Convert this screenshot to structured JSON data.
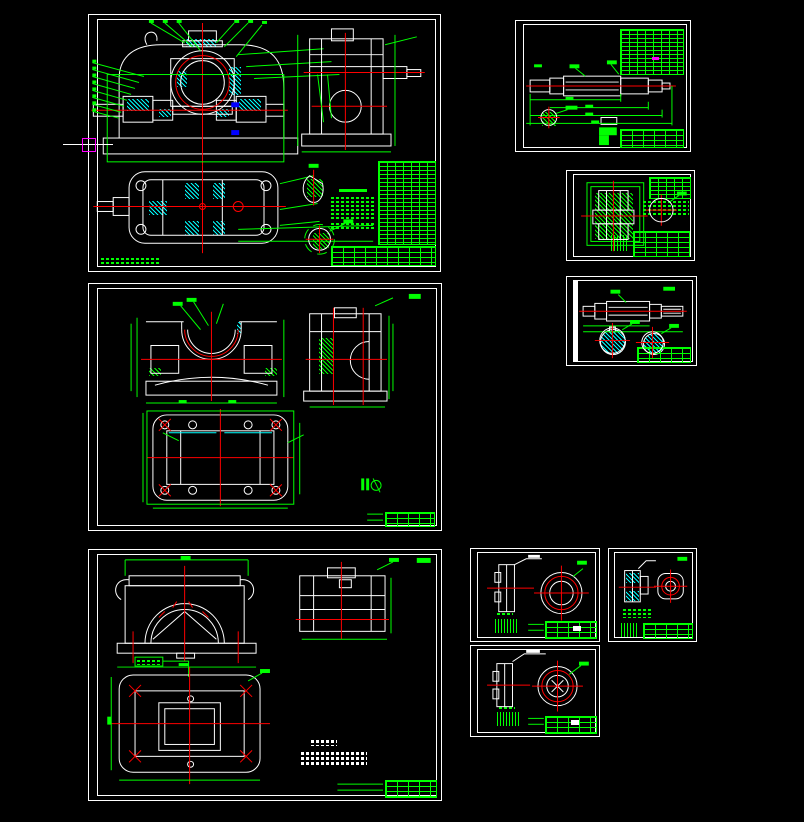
{
  "window": {
    "type": "cad-drawing-workspace",
    "background": "#000000"
  },
  "colors": {
    "bg": "#000000",
    "w": "#FFFFFF",
    "g": "#00FF00",
    "r": "#FF0000",
    "c": "#00FFFF",
    "m": "#FF00FF",
    "b": "#0000FF"
  },
  "cursor": {
    "visible": true,
    "style": "crosshair-with-magenta-pickbox"
  },
  "sheets": [
    {
      "id": "assembly-drawing-gearbox",
      "views": [
        "front-section",
        "side-view",
        "top-section",
        "detail-a",
        "detail-b"
      ],
      "tables": [
        "parts-list",
        "title-block"
      ],
      "annotation_color": "#00FF00"
    },
    {
      "id": "input-shaft-drawing",
      "views": [
        "shaft-profile",
        "end-section-detail",
        "keyway-detail"
      ],
      "tables": [
        "parameter-table",
        "title-block"
      ],
      "annotation_color": "#00FF00"
    },
    {
      "id": "worm-gear-drawing",
      "views": [
        "gear-section",
        "end-view"
      ],
      "tables": [
        "parameter-table",
        "title-block"
      ],
      "annotation_color": "#00FF00"
    },
    {
      "id": "worm-shaft-drawing",
      "views": [
        "shaft-profile",
        "section-a",
        "section-b"
      ],
      "tables": [
        "title-block"
      ],
      "hatch_color": "#00FFFF"
    },
    {
      "id": "housing-base-drawing",
      "views": [
        "front-view",
        "side-view",
        "top-view"
      ],
      "tables": [
        "title-block"
      ],
      "annotation_color": "#00FF00"
    },
    {
      "id": "housing-cover-drawing",
      "views": [
        "front-view",
        "side-view",
        "top-view"
      ],
      "tables": [
        "title-block"
      ],
      "notes": "technical-requirements-text"
    },
    {
      "id": "bearing-end-cap-drawing-1",
      "views": [
        "section-view",
        "front-circular-view"
      ],
      "tables": [
        "title-block"
      ]
    },
    {
      "id": "small-flange-cap-drawing",
      "views": [
        "section-view",
        "front-view"
      ],
      "tables": [
        "title-block"
      ],
      "hatch_color": "#00FFFF"
    },
    {
      "id": "bearing-end-cap-drawing-2",
      "views": [
        "section-view",
        "front-circular-view"
      ],
      "tables": [
        "title-block"
      ]
    }
  ]
}
